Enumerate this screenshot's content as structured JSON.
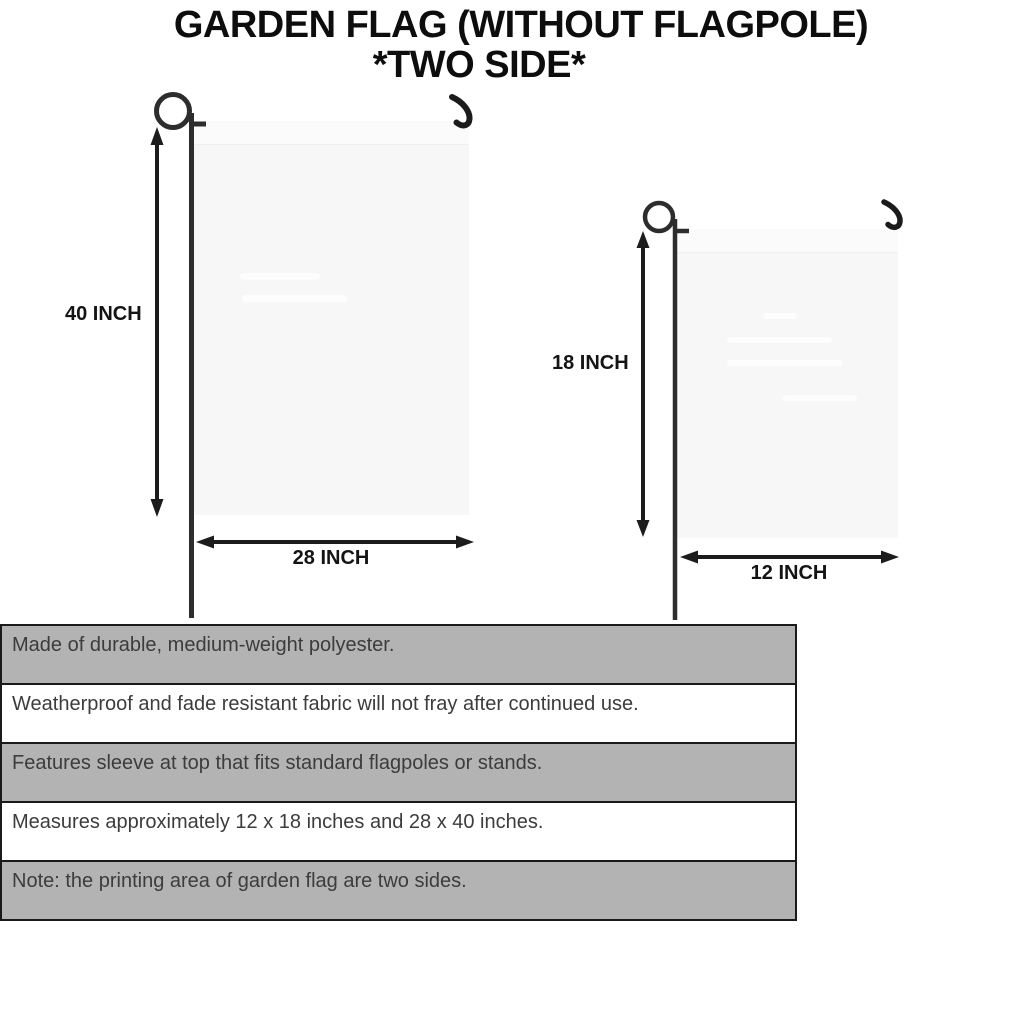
{
  "title": {
    "line1": "GARDEN FLAG (WITHOUT FLAGPOLE)",
    "line2": "*TWO SIDE*"
  },
  "diagram": {
    "large_flag": {
      "height_label": "40 INCH",
      "width_label": "28 INCH"
    },
    "small_flag": {
      "height_label": "18 INCH",
      "width_label": "12 INCH"
    }
  },
  "features": {
    "rows": [
      {
        "text": "Made of durable, medium-weight polyester.",
        "shaded": true
      },
      {
        "text": "Weatherproof and fade resistant fabric will not fray after continued use.",
        "shaded": false
      },
      {
        "text": "Features sleeve at top that fits standard flagpoles or stands.",
        "shaded": true
      },
      {
        "text": "Measures approximately 12 x 18 inches and 28 x 40 inches.",
        "shaded": false
      },
      {
        "text": "Note: the printing area of garden flag are two sides.",
        "shaded": true
      }
    ]
  },
  "colors": {
    "row_shaded": "#b3b3b3",
    "row_plain": "#ffffff",
    "table_border": "#1a1a1a",
    "flag_fill": "#f7f7f7",
    "hardware": "#2d2d2d",
    "hook": "#1b1b1b",
    "arrow": "#1c1c1c",
    "feature_text": "#3c3c3c",
    "title_text": "#0d0d0d"
  }
}
